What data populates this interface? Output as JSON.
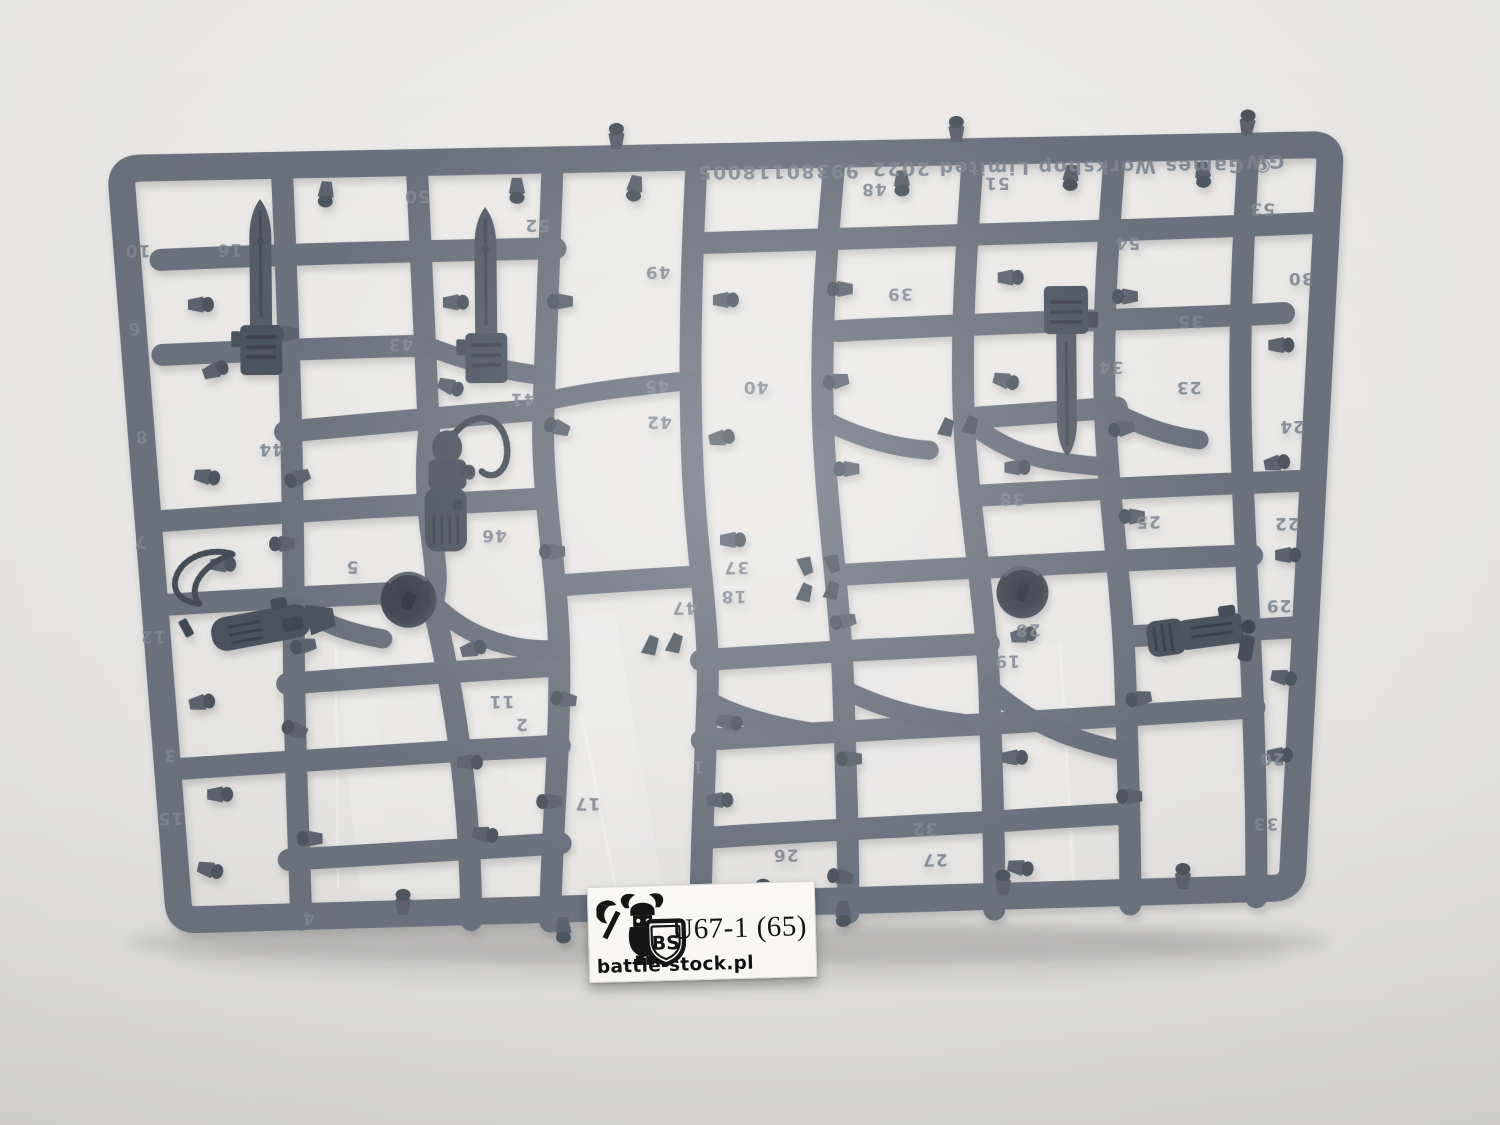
{
  "photo": {
    "background_color": "#e9e8e6",
    "plastic_color": "#6a727d",
    "plastic_dark_color": "#4c5560",
    "emboss_color": "#7f8792"
  },
  "sprue": {
    "brand_text": "GW",
    "copyright_text": "© Games Workshop Limited 2022",
    "product_code": "99380118005",
    "text_orientation": "upside-down",
    "part_numbers": [
      {
        "label": "10",
        "x": 140,
        "y": 252
      },
      {
        "label": "16",
        "x": 232,
        "y": 252
      },
      {
        "label": "6",
        "x": 136,
        "y": 330
      },
      {
        "label": "8",
        "x": 142,
        "y": 438
      },
      {
        "label": "44",
        "x": 272,
        "y": 452
      },
      {
        "label": "7",
        "x": 140,
        "y": 543
      },
      {
        "label": "12",
        "x": 152,
        "y": 638
      },
      {
        "label": "3",
        "x": 168,
        "y": 757
      },
      {
        "label": "15",
        "x": 168,
        "y": 820
      },
      {
        "label": "50",
        "x": 420,
        "y": 200
      },
      {
        "label": "52",
        "x": 540,
        "y": 230
      },
      {
        "label": "43",
        "x": 402,
        "y": 348
      },
      {
        "label": "41",
        "x": 524,
        "y": 404
      },
      {
        "label": "46",
        "x": 494,
        "y": 540
      },
      {
        "label": "5",
        "x": 352,
        "y": 570
      },
      {
        "label": "11",
        "x": 500,
        "y": 706
      },
      {
        "label": "2",
        "x": 520,
        "y": 729
      },
      {
        "label": "1",
        "x": 696,
        "y": 773
      },
      {
        "label": "17",
        "x": 585,
        "y": 809
      },
      {
        "label": "4",
        "x": 305,
        "y": 921
      },
      {
        "label": "49",
        "x": 660,
        "y": 278
      },
      {
        "label": "45",
        "x": 658,
        "y": 392
      },
      {
        "label": "42",
        "x": 660,
        "y": 428
      },
      {
        "label": "40",
        "x": 757,
        "y": 394
      },
      {
        "label": "37",
        "x": 736,
        "y": 574
      },
      {
        "label": "18",
        "x": 733,
        "y": 603
      },
      {
        "label": "47",
        "x": 684,
        "y": 614
      },
      {
        "label": "26",
        "x": 783,
        "y": 862
      },
      {
        "label": "48",
        "x": 877,
        "y": 197
      },
      {
        "label": "51",
        "x": 1000,
        "y": 192
      },
      {
        "label": "39",
        "x": 902,
        "y": 302
      },
      {
        "label": "38",
        "x": 1012,
        "y": 508
      },
      {
        "label": "28",
        "x": 1027,
        "y": 639
      },
      {
        "label": "19",
        "x": 1006,
        "y": 670
      },
      {
        "label": "32",
        "x": 922,
        "y": 837
      },
      {
        "label": "27",
        "x": 932,
        "y": 868
      },
      {
        "label": "54",
        "x": 1130,
        "y": 253
      },
      {
        "label": "34",
        "x": 1112,
        "y": 377
      },
      {
        "label": "35",
        "x": 1192,
        "y": 332
      },
      {
        "label": "23",
        "x": 1190,
        "y": 398
      },
      {
        "label": "25",
        "x": 1148,
        "y": 532
      },
      {
        "label": "24",
        "x": 1293,
        "y": 438
      },
      {
        "label": "22",
        "x": 1287,
        "y": 535
      },
      {
        "label": "29",
        "x": 1278,
        "y": 617
      },
      {
        "label": "20",
        "x": 1270,
        "y": 770
      },
      {
        "label": "33",
        "x": 1263,
        "y": 835
      },
      {
        "label": "53",
        "x": 1265,
        "y": 220
      },
      {
        "label": "30",
        "x": 1303,
        "y": 290
      }
    ]
  },
  "label": {
    "code": "U67-1 (65)",
    "website": "battle-stock.pl",
    "logo_monogram": "BS",
    "background_color": "#f9f8f5",
    "text_color": "#141414"
  }
}
